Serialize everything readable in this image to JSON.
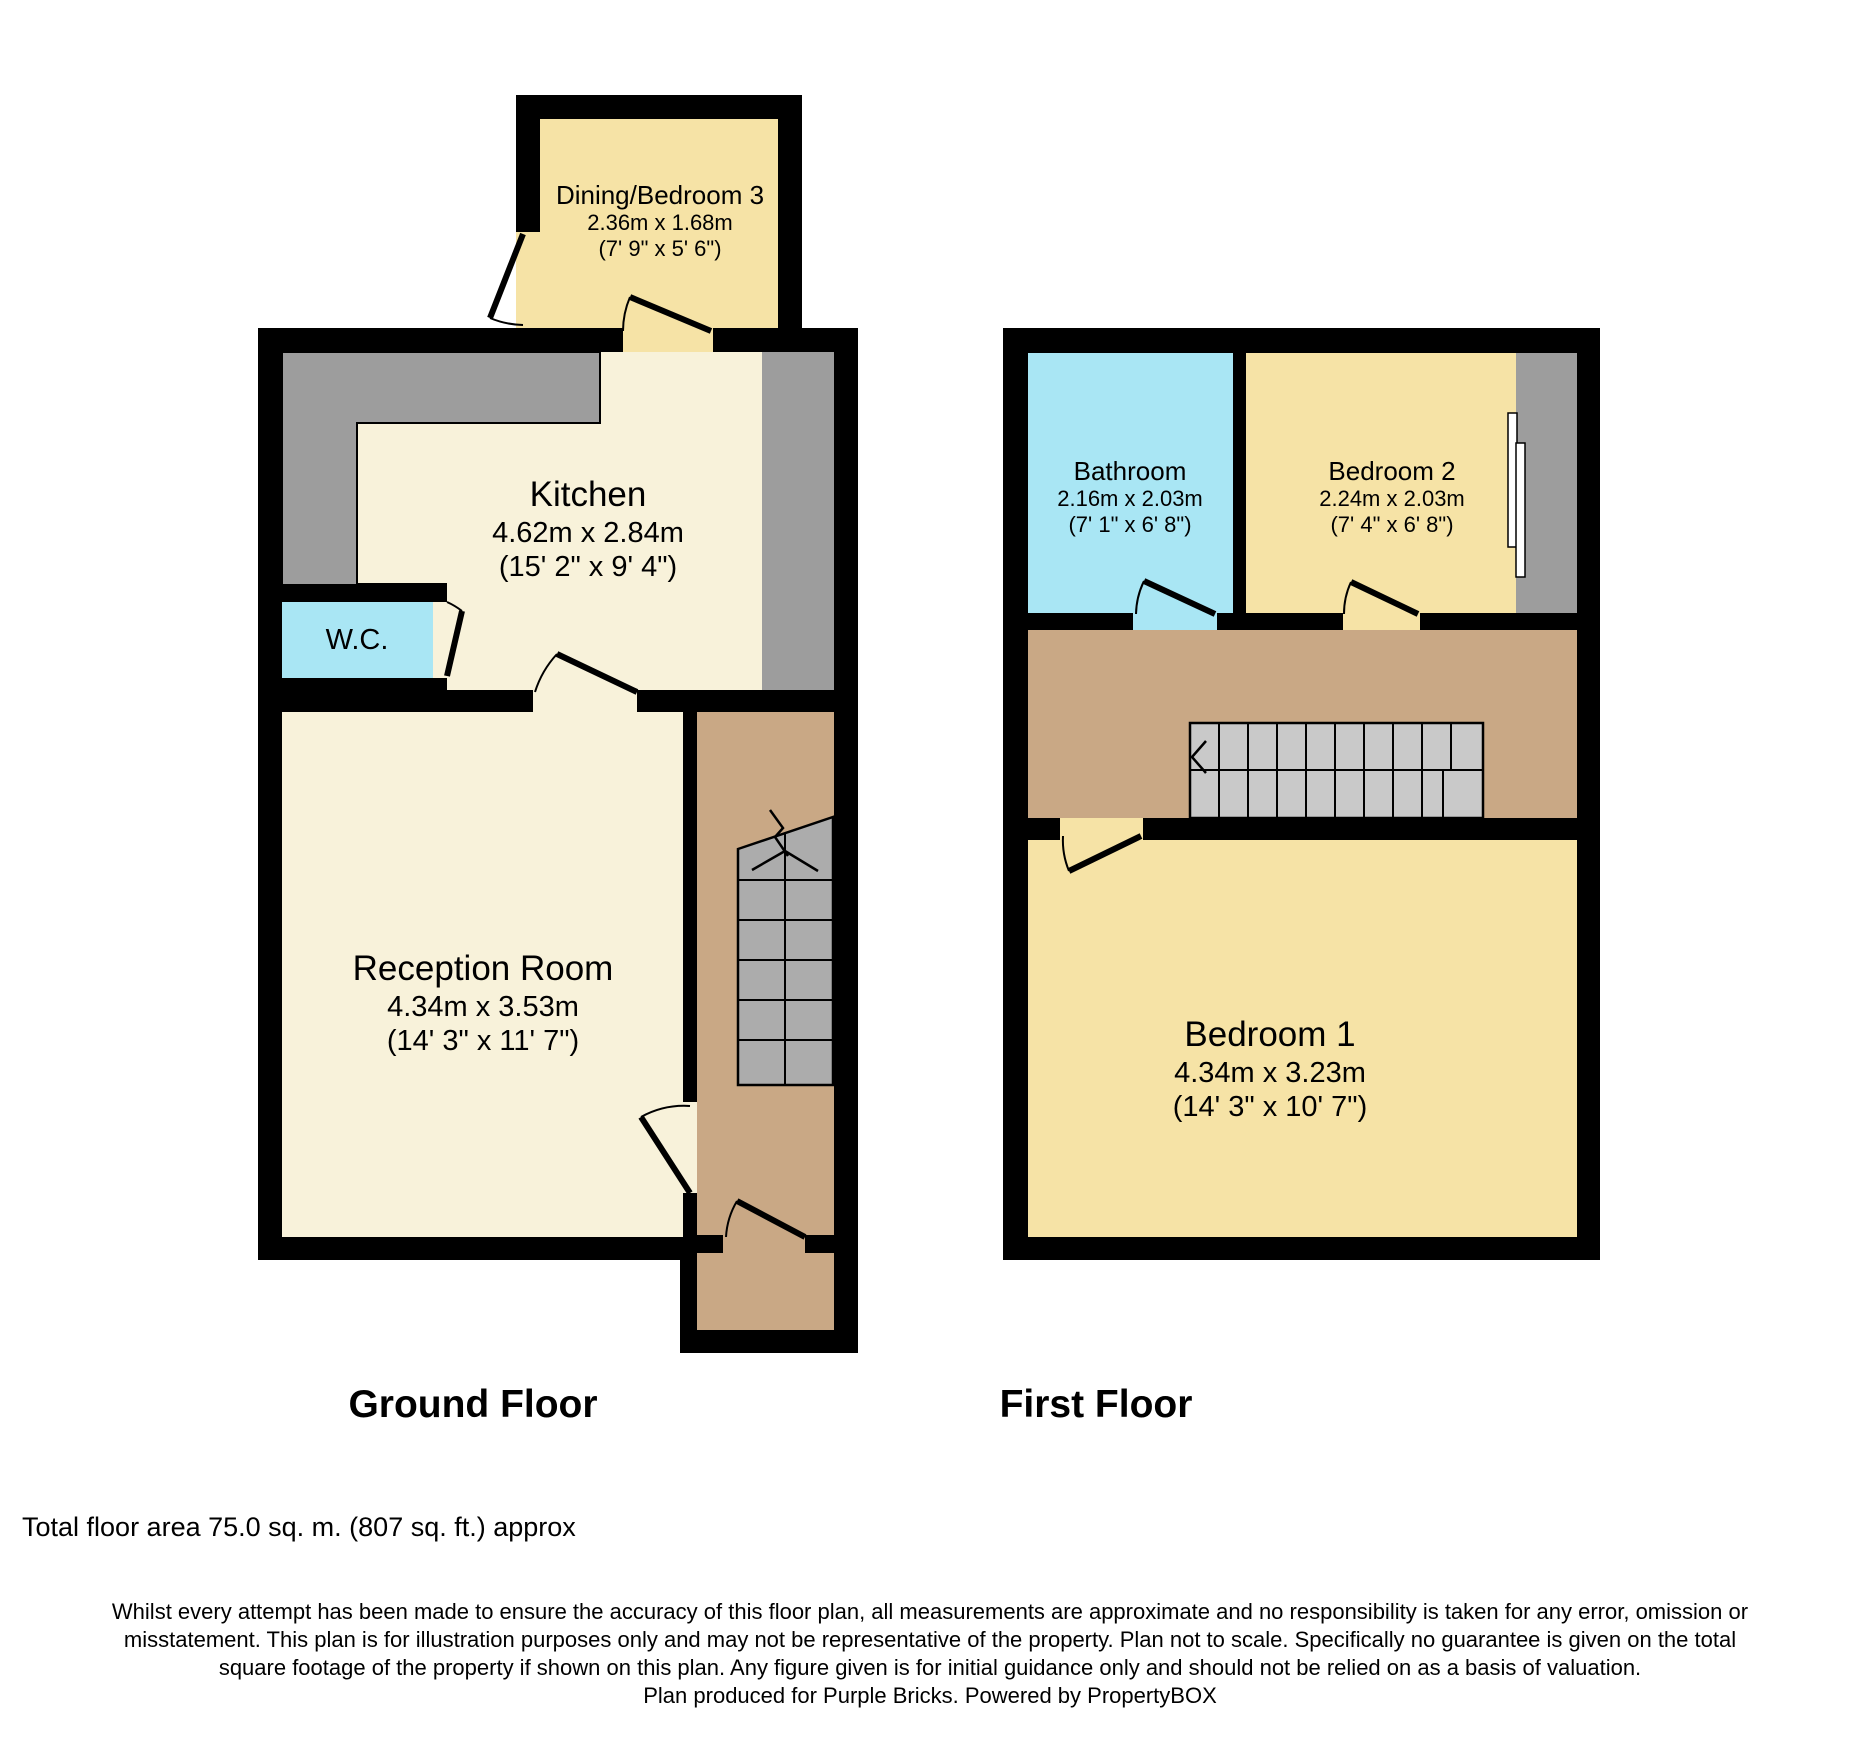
{
  "ground_floor": {
    "title": "Ground Floor",
    "rooms": {
      "dining_bedroom3": {
        "name": "Dining/Bedroom 3",
        "size_metric": "2.36m x 1.68m",
        "size_imperial": "(7' 9\" x 5' 6\")"
      },
      "kitchen": {
        "name": "Kitchen",
        "size_metric": "4.62m x 2.84m",
        "size_imperial": "(15' 2\" x 9' 4\")"
      },
      "wc": {
        "name": "W.C."
      },
      "reception_room": {
        "name": "Reception Room",
        "size_metric": "4.34m x 3.53m",
        "size_imperial": "(14' 3\" x 11' 7\")"
      }
    }
  },
  "first_floor": {
    "title": "First Floor",
    "rooms": {
      "bathroom": {
        "name": "Bathroom",
        "size_metric": "2.16m x 2.03m",
        "size_imperial": "(7' 1\" x 6' 8\")"
      },
      "bedroom2": {
        "name": "Bedroom 2",
        "size_metric": "2.24m x 2.03m",
        "size_imperial": "(7' 4\" x 6' 8\")"
      },
      "bedroom1": {
        "name": "Bedroom 1",
        "size_metric": "4.34m x 3.23m",
        "size_imperial": "(14' 3\" x 10' 7\")"
      }
    }
  },
  "footer": {
    "total_area": "Total floor area 75.0 sq. m. (807 sq. ft.) approx",
    "disclaimer_lines": [
      "Whilst every attempt has been made to ensure the accuracy of this floor plan, all measurements are approximate and no responsibility is taken for any error, omission or",
      "misstatement. This plan is for illustration purposes only and may not be representative of the property. Plan not to scale. Specifically no guarantee is given on the total",
      "square footage of the property if shown on this plan. Any figure given is for initial guidance only and should not be relied on as a basis of valuation.",
      "Plan produced for Purple Bricks. Powered by PropertyBOX"
    ]
  },
  "colors": {
    "room_yellow": "#F6E3A6",
    "room_cream": "#F8F2DA",
    "room_cyan": "#A9E6F4",
    "hall_tan": "#C9A885",
    "counter_gray": "#9D9D9D",
    "stairs_gray_ground": "#ACACAC",
    "stairs_gray_first": "#C9C9C9",
    "wall_black": "#000000"
  }
}
